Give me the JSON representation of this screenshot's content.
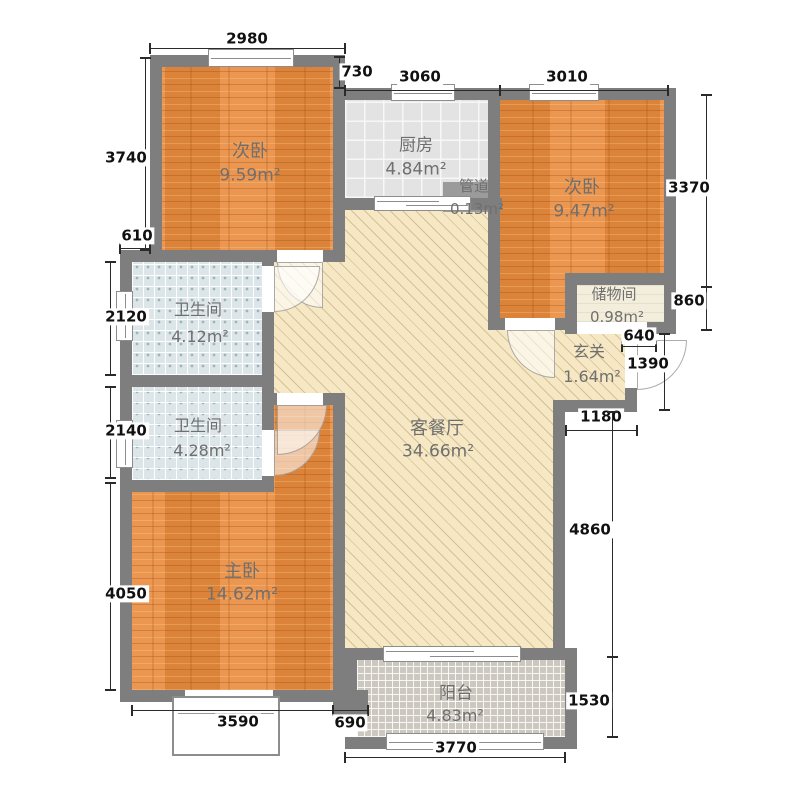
{
  "meta": {
    "type": "apartment-floor-plan"
  },
  "colors": {
    "wall": "#7e7e7e",
    "wood_floor": "#e98b3d",
    "living_floor": "#f6e8c5",
    "kitchen_tile": "#e3e3e3",
    "bath_tile": "#dce6e9",
    "balcony_tile": "#ccc8bf",
    "storage_floor": "#f3eddc",
    "room_text": "#6f6f6f",
    "dim_text": "#111111",
    "background": "#ffffff"
  },
  "rooms_legend": [
    {
      "label": "次卧",
      "area": "9.59m²"
    },
    {
      "label": "厨房",
      "area": "4.84m²"
    },
    {
      "label": "管道",
      "area": "0.13m²"
    },
    {
      "label": "次卧",
      "area": "9.47m²"
    },
    {
      "label": "储物间",
      "area": "0.98m²"
    },
    {
      "label": "玄关",
      "area": "1.64m²"
    },
    {
      "label": "卫生间",
      "area": "4.12m²"
    },
    {
      "label": "卫生间",
      "area": "4.28m²"
    },
    {
      "label": "客餐厅",
      "area": "34.66m²"
    },
    {
      "label": "主卧",
      "area": "14.62m²"
    },
    {
      "label": "阳台",
      "area": "4.83m²"
    }
  ],
  "floors": [
    {
      "name": "living-dining-floor",
      "cls": "beige",
      "x": 345,
      "y": 210,
      "w": 143,
      "h": 120
    },
    {
      "name": "living-dining-floor",
      "cls": "beige",
      "x": 274,
      "y": 262,
      "w": 71,
      "h": 131
    },
    {
      "name": "living-dining-floor",
      "cls": "beige",
      "x": 345,
      "y": 330,
      "w": 280,
      "h": 82
    },
    {
      "name": "living-dining-floor",
      "cls": "beige",
      "x": 345,
      "y": 385,
      "w": 208,
      "h": 263
    },
    {
      "name": "master-bedroom-floor",
      "cls": "wood",
      "x": 132,
      "y": 405,
      "w": 201,
      "h": 285
    },
    {
      "name": "bathroom2-floor",
      "cls": "bath",
      "x": 132,
      "y": 387,
      "w": 130,
      "h": 93
    },
    {
      "name": "bathroom1-floor",
      "cls": "bath",
      "x": 132,
      "y": 262,
      "w": 130,
      "h": 113
    },
    {
      "name": "bedroom1-floor",
      "cls": "wood",
      "x": 162,
      "y": 67,
      "w": 171,
      "h": 183
    },
    {
      "name": "kitchen-floor",
      "cls": "kitchen",
      "x": 345,
      "y": 100,
      "w": 143,
      "h": 98
    },
    {
      "name": "bedroom2-floor",
      "cls": "wood",
      "x": 500,
      "y": 100,
      "w": 164,
      "h": 218
    },
    {
      "name": "storage-floor",
      "cls": "storage",
      "x": 577,
      "y": 285,
      "w": 87,
      "h": 37
    },
    {
      "name": "balcony-floor",
      "cls": "balcony",
      "x": 357,
      "y": 660,
      "w": 208,
      "h": 77
    },
    {
      "name": "pipe-duct-box",
      "cls": "duct",
      "x": 443,
      "y": 182,
      "w": 47,
      "h": 30
    }
  ],
  "walls": [
    [
      150,
      55,
      195,
      12
    ],
    [
      150,
      55,
      12,
      207
    ],
    [
      333,
      55,
      12,
      207
    ],
    [
      333,
      88,
      343,
      12
    ],
    [
      664,
      88,
      12,
      242
    ],
    [
      488,
      100,
      12,
      230
    ],
    [
      333,
      198,
      169,
      12
    ],
    [
      120,
      250,
      225,
      12
    ],
    [
      120,
      250,
      12,
      242
    ],
    [
      120,
      375,
      154,
      12
    ],
    [
      262,
      262,
      12,
      230
    ],
    [
      120,
      480,
      154,
      12
    ],
    [
      120,
      492,
      12,
      210
    ],
    [
      274,
      393,
      71,
      12
    ],
    [
      333,
      393,
      12,
      309
    ],
    [
      120,
      690,
      225,
      12
    ],
    [
      488,
      318,
      77,
      12
    ],
    [
      565,
      273,
      111,
      12
    ],
    [
      565,
      273,
      12,
      57
    ],
    [
      565,
      322,
      111,
      12
    ],
    [
      625,
      334,
      12,
      78
    ],
    [
      553,
      400,
      84,
      12
    ],
    [
      553,
      412,
      12,
      248
    ],
    [
      333,
      648,
      232,
      12
    ],
    [
      345,
      648,
      12,
      60
    ],
    [
      333,
      690,
      35,
      25
    ],
    [
      565,
      648,
      12,
      101
    ],
    [
      345,
      737,
      232,
      12
    ]
  ],
  "windows": [
    {
      "name": "bedroom1-window",
      "x": 208,
      "y": 49,
      "w": 86,
      "h": 18,
      "t": "wh"
    },
    {
      "name": "kitchen-window",
      "x": 391,
      "y": 84,
      "w": 64,
      "h": 17,
      "t": "wh"
    },
    {
      "name": "bedroom2-window",
      "x": 529,
      "y": 84,
      "w": 70,
      "h": 17,
      "t": "wh"
    },
    {
      "name": "bathroom1-window",
      "x": 116,
      "y": 291,
      "w": 17,
      "h": 50,
      "t": "wv"
    },
    {
      "name": "bathroom2-window",
      "x": 116,
      "y": 420,
      "w": 17,
      "h": 48,
      "t": "wv"
    },
    {
      "name": "balcony-window",
      "x": 386,
      "y": 733,
      "w": 158,
      "h": 17,
      "t": "wh"
    },
    {
      "name": "balcony-sliding-door",
      "x": 383,
      "y": 646,
      "w": 138,
      "h": 16,
      "t": "wh2"
    },
    {
      "name": "kitchen-sliding-door",
      "x": 374,
      "y": 196,
      "w": 97,
      "h": 15,
      "t": "wh2"
    }
  ],
  "thresholds": [
    [
      277,
      250,
      46,
      12
    ],
    [
      262,
      266,
      12,
      46
    ],
    [
      262,
      430,
      12,
      46
    ],
    [
      277,
      393,
      46,
      12
    ],
    [
      505,
      318,
      50,
      12
    ],
    [
      577,
      322,
      70,
      12
    ],
    [
      625,
      340,
      12,
      48
    ],
    [
      185,
      690,
      88,
      12
    ]
  ],
  "bay_window": {
    "name": "master-bay-window",
    "x": 172,
    "y": 696,
    "w": 108,
    "h": 60
  },
  "doors": [
    {
      "name": "bedroom1-door-arc",
      "x": 277,
      "y": 262,
      "w": 46,
      "h": 46,
      "c": "c-bl"
    },
    {
      "name": "bathroom1-door-arc",
      "x": 274,
      "y": 266,
      "w": 46,
      "h": 46,
      "c": "c-br"
    },
    {
      "name": "bathroom2-door-arc",
      "x": 274,
      "y": 430,
      "w": 46,
      "h": 46,
      "c": "c-br"
    },
    {
      "name": "master-bedroom-door-arc",
      "x": 277,
      "y": 405,
      "w": 50,
      "h": 50,
      "c": "c-br"
    },
    {
      "name": "bedroom2-door-arc",
      "x": 507,
      "y": 330,
      "w": 48,
      "h": 48,
      "c": "c-bl"
    },
    {
      "name": "entrance-door-arc",
      "x": 637,
      "y": 340,
      "w": 50,
      "h": 50,
      "c": "c-br"
    }
  ],
  "dims": [
    {
      "label": "2980",
      "x1": 150,
      "y1": 48,
      "x2": 345,
      "y2": 48,
      "lx": 247,
      "ly": 39
    },
    {
      "label": "730",
      "x1": 339,
      "y1": 57,
      "x2": 339,
      "y2": 88,
      "lx": 357,
      "ly": 72
    },
    {
      "label": "3060",
      "x1": 345,
      "y1": 90,
      "x2": 500,
      "y2": 90,
      "lx": 420,
      "ly": 77
    },
    {
      "label": "3010",
      "x1": 500,
      "y1": 90,
      "x2": 668,
      "y2": 90,
      "lx": 567,
      "ly": 77
    },
    {
      "label": "3740",
      "x1": 145,
      "y1": 58,
      "x2": 145,
      "y2": 250,
      "lx": 126,
      "ly": 158
    },
    {
      "label": "610",
      "x1": 120,
      "y1": 248,
      "x2": 150,
      "y2": 248,
      "lx": 137,
      "ly": 236
    },
    {
      "label": "2120",
      "x1": 110,
      "y1": 262,
      "x2": 110,
      "y2": 375,
      "lx": 126,
      "ly": 317
    },
    {
      "label": "2140",
      "x1": 110,
      "y1": 387,
      "x2": 110,
      "y2": 478,
      "lx": 126,
      "ly": 431
    },
    {
      "label": "4050",
      "x1": 110,
      "y1": 483,
      "x2": 110,
      "y2": 690,
      "lx": 126,
      "ly": 594
    },
    {
      "label": "3370",
      "x1": 706,
      "y1": 95,
      "x2": 706,
      "y2": 287,
      "lx": 689,
      "ly": 188
    },
    {
      "label": "860",
      "x1": 706,
      "y1": 287,
      "x2": 706,
      "y2": 330,
      "lx": 689,
      "ly": 301
    },
    {
      "label": "640",
      "x1": 622,
      "y1": 346,
      "x2": 656,
      "y2": 346,
      "lx": 639,
      "ly": 336
    },
    {
      "label": "1390",
      "x1": 664,
      "y1": 334,
      "x2": 664,
      "y2": 410,
      "lx": 648,
      "ly": 364
    },
    {
      "label": "1180",
      "x1": 566,
      "y1": 430,
      "x2": 637,
      "y2": 430,
      "lx": 601,
      "ly": 417
    },
    {
      "label": "4860",
      "x1": 612,
      "y1": 412,
      "x2": 612,
      "y2": 657,
      "lx": 590,
      "ly": 530
    },
    {
      "label": "1530",
      "x1": 612,
      "y1": 657,
      "x2": 612,
      "y2": 737,
      "lx": 589,
      "ly": 701
    },
    {
      "label": "3590",
      "x1": 132,
      "y1": 710,
      "x2": 333,
      "y2": 710,
      "lx": 238,
      "ly": 722
    },
    {
      "label": "690",
      "x1": 333,
      "y1": 710,
      "x2": 368,
      "y2": 710,
      "lx": 350,
      "ly": 723
    },
    {
      "label": "3770",
      "x1": 345,
      "y1": 757,
      "x2": 565,
      "y2": 757,
      "lx": 456,
      "ly": 748
    }
  ],
  "labels": [
    {
      "text": "次卧",
      "x": 250,
      "y": 152,
      "s": 18
    },
    {
      "text": "9.59m²",
      "x": 250,
      "y": 176,
      "s": 17
    },
    {
      "text": "厨房",
      "x": 416,
      "y": 146,
      "s": 17
    },
    {
      "text": "4.84m²",
      "x": 416,
      "y": 170,
      "s": 17
    },
    {
      "text": "管道",
      "x": 474,
      "y": 186,
      "s": 15
    },
    {
      "text": "0.13m²",
      "x": 477,
      "y": 209,
      "s": 15
    },
    {
      "text": "次卧",
      "x": 582,
      "y": 188,
      "s": 18
    },
    {
      "text": "9.47m²",
      "x": 584,
      "y": 212,
      "s": 17
    },
    {
      "text": "储物间",
      "x": 614,
      "y": 294,
      "s": 15
    },
    {
      "text": "0.98m²",
      "x": 617,
      "y": 317,
      "s": 15
    },
    {
      "text": "玄关",
      "x": 589,
      "y": 352,
      "s": 16
    },
    {
      "text": "1.64m²",
      "x": 592,
      "y": 377,
      "s": 16
    },
    {
      "text": "卫生间",
      "x": 198,
      "y": 310,
      "s": 16
    },
    {
      "text": "4.12m²",
      "x": 200,
      "y": 337,
      "s": 16
    },
    {
      "text": "卫生间",
      "x": 198,
      "y": 426,
      "s": 16
    },
    {
      "text": "4.28m²",
      "x": 202,
      "y": 451,
      "s": 16
    },
    {
      "text": "客餐厅",
      "x": 437,
      "y": 429,
      "s": 18
    },
    {
      "text": "34.66m²",
      "x": 438,
      "y": 452,
      "s": 17
    },
    {
      "text": "主卧",
      "x": 242,
      "y": 572,
      "s": 18
    },
    {
      "text": "14.62m²",
      "x": 242,
      "y": 595,
      "s": 17
    },
    {
      "text": "阳台",
      "x": 456,
      "y": 694,
      "s": 17
    },
    {
      "text": "4.83m²",
      "x": 455,
      "y": 716,
      "s": 16
    }
  ]
}
